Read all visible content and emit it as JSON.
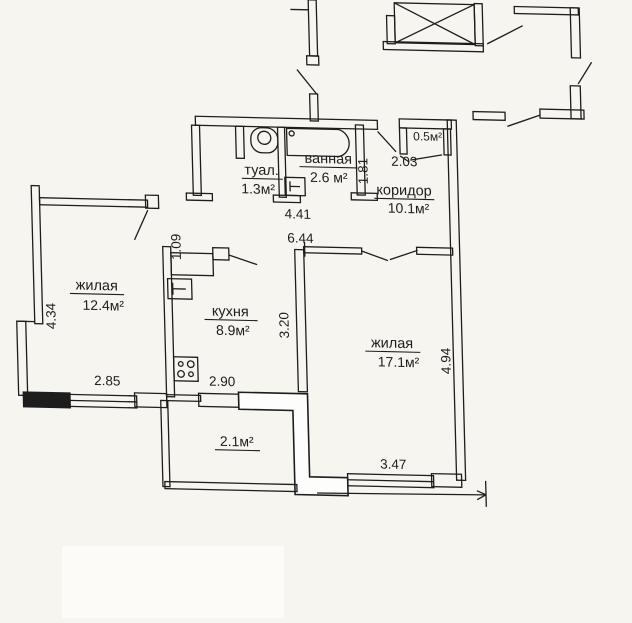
{
  "plan": {
    "rooms": {
      "living_left": {
        "name": "жилая",
        "area": "12.4м²"
      },
      "living_right": {
        "name": "жилая",
        "area": "17.1м²"
      },
      "kitchen": {
        "name": "кухня",
        "area": "8.9м²"
      },
      "corridor": {
        "name": "коридор",
        "area": "10.1м²"
      },
      "bathroom": {
        "name": "ванная",
        "area": "2.6 м²"
      },
      "toilet": {
        "name": "туал.",
        "area": "1.3м²"
      },
      "balcony": {
        "area": "2.1м²"
      },
      "storage": {
        "area": "0.5м²"
      }
    },
    "dimensions_m": {
      "hall_width": "4.41",
      "bath_depth": "1.81",
      "entry_width": "2.03",
      "total_width": "6.44",
      "doorway": "1.09",
      "kitchen_depth": "3.20",
      "living_left_depth": "4.34",
      "living_left_width": "2.85",
      "kitchen_width": "2.90",
      "living_right_depth": "4.94",
      "living_right_width": "3.47"
    },
    "colors": {
      "ink": "#1d1d1d",
      "paper": "#f6f5f0"
    }
  }
}
